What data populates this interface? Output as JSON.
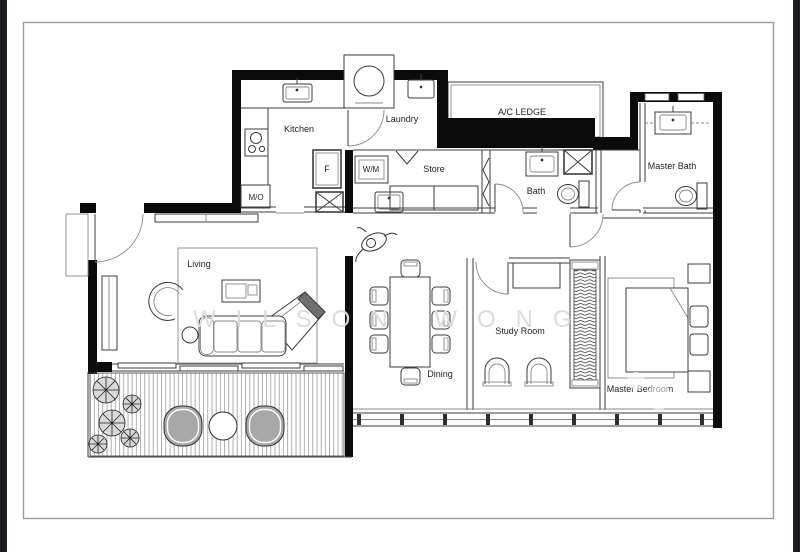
{
  "page": {
    "background": "#ffffff",
    "edge_bar_color": "#1d1d20",
    "frame_border_color": "#9b9b9b",
    "wall_color": "#0b0b0b",
    "line_color": "#3d3d3d",
    "watermark_color": "#dcdcdc",
    "lounge_chair_fill": "#a8a8a8"
  },
  "watermark": {
    "text": "WILSON WONG"
  },
  "rooms": {
    "kitchen": "Kitchen",
    "laundry": "Laundry",
    "ac_ledge": "A/C LEDGE",
    "store": "Store",
    "bath": "Bath",
    "master_bath": "Master Bath",
    "living": "Living",
    "dining": "Dining",
    "study_room": "Study Room",
    "master_bedroom": "Master Bedroom"
  },
  "fixtures": {
    "fridge": "F",
    "washer": "W/M",
    "microwave": "M/O"
  }
}
